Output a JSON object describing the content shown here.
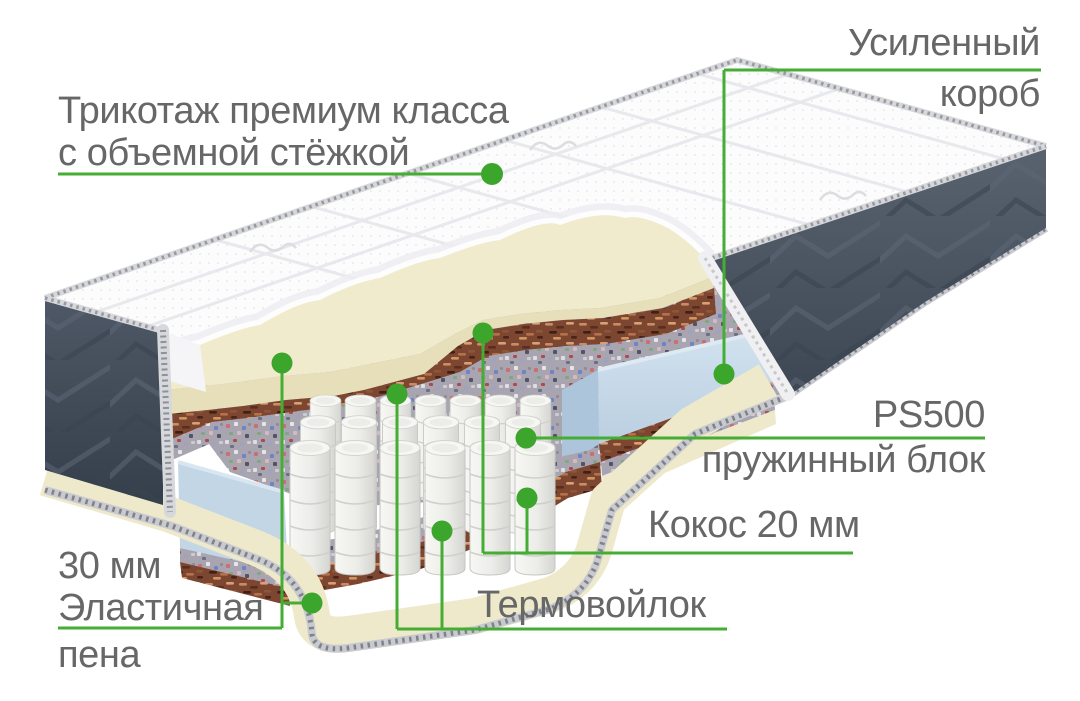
{
  "page": {
    "language": "ru",
    "background": "#FFFFFF",
    "type": "mattress-layers-infographic"
  },
  "colors": {
    "accent_green_line": "#46AD34",
    "accent_green_dot": "#3CA52C",
    "label_text": "#666766",
    "fabric_dark": "#4B5563",
    "foam_cream": "#F0EACE",
    "coconut_brown": "#7C4631",
    "felt_speckle": "#A8A5B1",
    "spring_box_blue": "#C5D8E8",
    "springs_white": "#EDEDEA"
  },
  "callouts": {
    "tricot": {
      "line1": "Трикотаж премиум класса",
      "line2": "с объемной стёжкой"
    },
    "korob": {
      "line1": "Усиленный",
      "line2": "короб"
    },
    "ps500": {
      "title": "PS500",
      "subtitle": "пружинный блок"
    },
    "kokos": {
      "text": "Кокос 20 мм"
    },
    "termo": {
      "text": "Термовойлок"
    },
    "pena": {
      "line1": "30 мм",
      "line2": "Эластичная",
      "line3": "пена"
    }
  }
}
